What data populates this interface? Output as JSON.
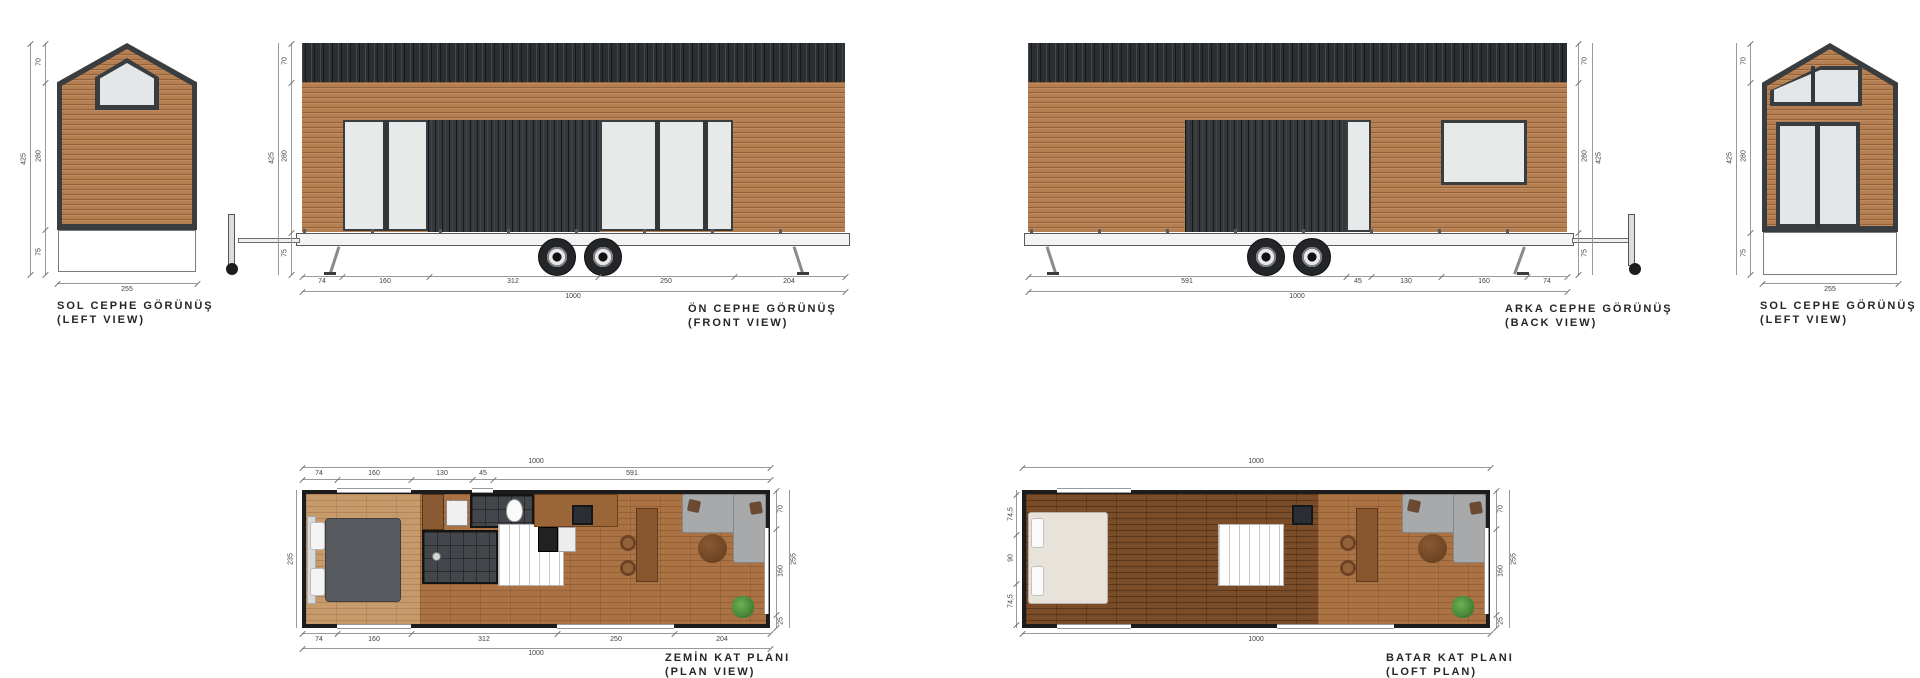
{
  "sheet": {
    "background": "#ffffff"
  },
  "colors": {
    "wood_siding": "#b57f51",
    "roof_metal": "#2c2f32",
    "window_glass": "#e8eaea",
    "window_frame": "#3b3e40",
    "plan_wall": "#1c1c1c",
    "floor_light": "#c69a6b",
    "floor_mid": "#ab7344",
    "floor_loft": "#7a4c28",
    "bathroom_tile": "#43474b",
    "dim_text": "#3f3f3f"
  },
  "views": {
    "left_view_1": {
      "title": "SOL CEPHE GÖRÜNÜŞ",
      "subtitle": "(LEFT VIEW)",
      "dims": {
        "total": "425",
        "roof": "70",
        "wall": "280",
        "base": "75",
        "width": "255"
      }
    },
    "front_view": {
      "title": "ÖN CEPHE GÖRÜNÜŞ",
      "subtitle": "(FRONT VIEW)",
      "dims": {
        "total": "425",
        "roof": "70",
        "wall": "280",
        "base": "75",
        "segments": [
          "74",
          "160",
          "312",
          "250",
          "204"
        ],
        "overall": "1000"
      }
    },
    "back_view": {
      "title": "ARKA CEPHE GÖRÜNÜŞ",
      "subtitle": "(BACK VIEW)",
      "dims": {
        "total": "425",
        "roof": "70",
        "wall": "280",
        "base": "75",
        "segments": [
          "591",
          "45",
          "130",
          "160",
          "74"
        ],
        "overall": "1000"
      }
    },
    "left_view_2": {
      "title": "SOL CEPHE GÖRÜNÜŞ",
      "subtitle": "(LEFT VIEW)",
      "dims": {
        "total": "425",
        "roof": "70",
        "wall": "280",
        "base": "75",
        "width": "255"
      }
    },
    "ground_plan": {
      "title": "ZEMİN KAT PLANI",
      "subtitle": "(PLAN VIEW)",
      "dims": {
        "overall_top": "1000",
        "top_segments": [
          "74",
          "160",
          "130",
          "45",
          "591"
        ],
        "bottom_segments": [
          "74",
          "160",
          "312",
          "250",
          "204"
        ],
        "overall_bottom": "1000",
        "right_segments": [
          "70",
          "160",
          "25"
        ],
        "right_overall": "255",
        "left_overall": "235"
      }
    },
    "loft_plan": {
      "title": "BATAR KAT PLANI",
      "subtitle": "(LOFT PLAN)",
      "dims": {
        "overall_top": "1000",
        "overall_bottom": "1000",
        "left_segments": [
          "74,5",
          "90",
          "74,5"
        ],
        "right_segments": [
          "70",
          "160",
          "25"
        ],
        "right_overall": "255"
      }
    }
  }
}
